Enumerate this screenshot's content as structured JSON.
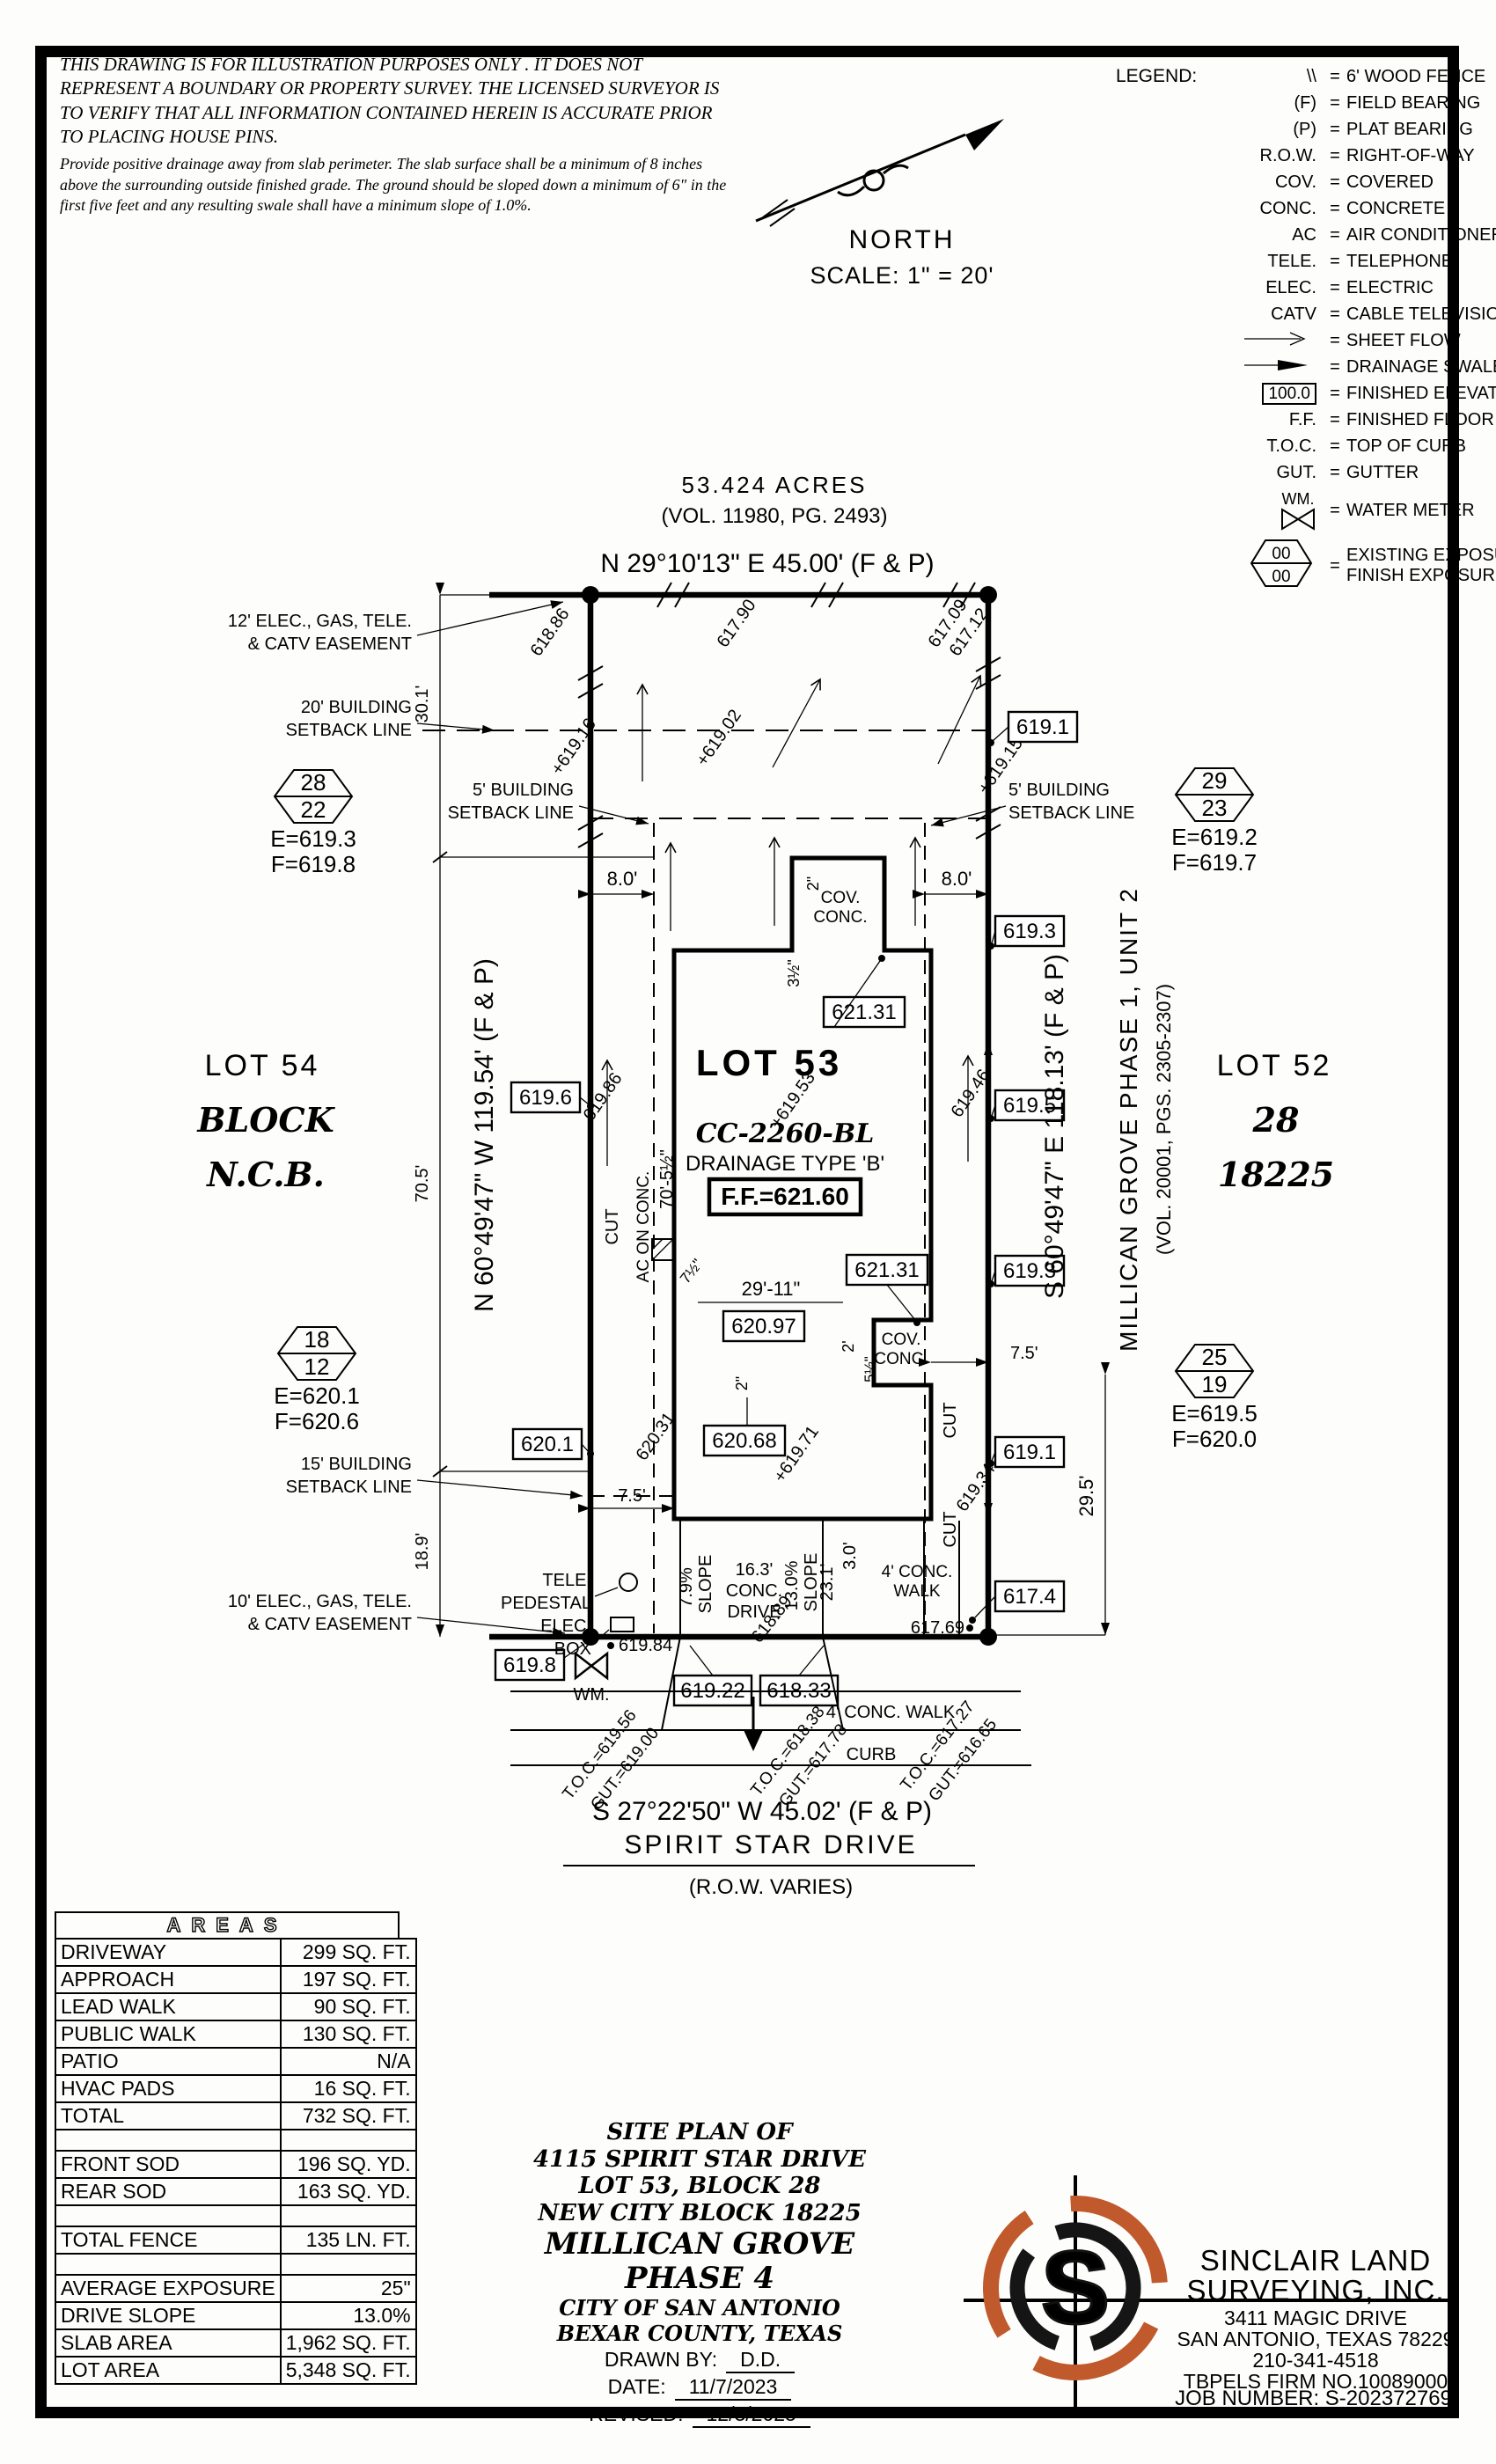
{
  "disclaimer": {
    "para1": "THIS DRAWING IS FOR ILLUSTRATION PURPOSES ONLY . IT DOES NOT REPRESENT A BOUNDARY OR PROPERTY SURVEY. THE LICENSED SURVEYOR IS TO VERIFY THAT ALL INFORMATION CONTAINED HEREIN IS ACCURATE PRIOR TO PLACING HOUSE PINS.",
    "para2": "Provide positive drainage away from slab perimeter. The slab surface shall be a minimum of 8 inches above the surrounding outside finished grade. The ground should be sloped down a minimum of 6\" in the first five feet and any resulting swale shall have a minimum slope of 1.0%."
  },
  "compass": {
    "north": "NORTH",
    "scale": "SCALE:  1\"  =  20'"
  },
  "legend": {
    "title": "LEGEND:",
    "eq": "=",
    "items": [
      {
        "sym": "\\\\",
        "desc": "6' WOOD FENCE"
      },
      {
        "sym": "(F)",
        "desc": "FIELD BEARING"
      },
      {
        "sym": "(P)",
        "desc": "PLAT BEARING"
      },
      {
        "sym": "R.O.W.",
        "desc": "RIGHT-OF-WAY"
      },
      {
        "sym": "COV.",
        "desc": "COVERED"
      },
      {
        "sym": "CONC.",
        "desc": "CONCRETE"
      },
      {
        "sym": "AC",
        "desc": "AIR CONDITIONER"
      },
      {
        "sym": "TELE.",
        "desc": "TELEPHONE"
      },
      {
        "sym": "ELEC.",
        "desc": "ELECTRIC"
      },
      {
        "sym": "CATV",
        "desc": "CABLE TELEVISION"
      },
      {
        "sym": "",
        "desc": "SHEET FLOW"
      },
      {
        "sym": "",
        "desc": "DRAINAGE SWALE"
      },
      {
        "sym": "100.0",
        "desc": "FINISHED ELEVATION"
      },
      {
        "sym": "F.F.",
        "desc": "FINISHED FLOOR"
      },
      {
        "sym": "T.O.C.",
        "desc": "TOP OF CURB"
      },
      {
        "sym": "GUT.",
        "desc": "GUTTER"
      },
      {
        "sym": "WM.",
        "desc": "WATER METER"
      },
      {
        "sym_top": "00",
        "sym_bot": "00",
        "desc": "EXISTING EXPOSURE",
        "desc2": "FINISH EXPOSURE"
      }
    ]
  },
  "survey": {
    "acres": "53.424 ACRES",
    "acres_vol": "(VOL. 11980, PG. 2493)",
    "brg_top": "N 29°10'13\" E 45.00' (F & P)",
    "brg_left": "N 60°49'47\" W 119.54' (F & P)",
    "brg_right": "S 60°49'47\" E 118.13' (F & P)",
    "brg_bottom": "S 27°22'50\" W 45.02' (F & P)",
    "street": "SPIRIT STAR DRIVE",
    "row_varies": "(R.O.W. VARIES)",
    "lot54": "LOT 54",
    "lot54_block": "BLOCK",
    "lot54_ncb": "N.C.B.",
    "lot52": "LOT 52",
    "lot52_block": "28",
    "lot52_ncb": "18225",
    "phase1": "MILLICAN GROVE PHASE 1, UNIT 2",
    "phase1_vol": "(VOL. 20001, PGS. 2305-2307)",
    "lot53": "LOT 53",
    "cc": "CC-2260-BL",
    "drainage": "DRAINAGE TYPE 'B'",
    "ff": "F.F.=621.60",
    "hex1a": "28",
    "hex1b": "22",
    "hex1e": "E=619.3",
    "hex1f": "F=619.8",
    "hex2a": "29",
    "hex2b": "23",
    "hex2e": "E=619.2",
    "hex2f": "F=619.7",
    "hex3a": "18",
    "hex3b": "12",
    "hex3e": "E=620.1",
    "hex3f": "F=620.6",
    "hex4a": "25",
    "hex4b": "19",
    "hex4e": "E=619.5",
    "hex4f": "F=620.0",
    "esmt12_1": "12' ELEC., GAS, TELE.",
    "esmt12_2": "& CATV EASEMENT",
    "sb20_1": "20' BUILDING",
    "sb20_2": "SETBACK LINE",
    "sb5_1": "5' BUILDING",
    "sb5_2": "SETBACK LINE",
    "sb15_1": "15' BUILDING",
    "sb15_2": "SETBACK LINE",
    "esmt10_1": "10' ELEC., GAS, TELE.",
    "esmt10_2": "& CATV EASEMENT",
    "tele_1": "TELE.",
    "tele_2": "PEDESTAL",
    "elec_1": "ELEC.",
    "elec_2": "BOX",
    "wm": "WM.",
    "curb": "CURB",
    "walk_bottom": "4' CONC. WALK",
    "walk_right_1": "4' CONC.",
    "walk_right_2": "WALK",
    "drive_1": "16.3'",
    "drive_2": "CONC.",
    "drive_3": "DRIVE",
    "slope1": "7.9%",
    "slope1_w": "SLOPE",
    "slope2": "13.0%",
    "slope2_w": "SLOPE",
    "cut": "CUT",
    "acon": "AC ON CONC.",
    "cov1": "COV.",
    "cov2": "CONC.",
    "d30_1": "30.1'",
    "d70_5": "70.5'",
    "d18_9": "18.9'",
    "d8_l": "8.0'",
    "d8_r": "8.0'",
    "d70_5h": "70'-5½\"",
    "d29_11": "29'-11\"",
    "d7_5l": "7.5'",
    "d7_5r": "7.5'",
    "d29_5": "29.5'",
    "d23_1": "23.1'",
    "d3_0": "3.0'",
    "d2in_a": "2\"",
    "d2in_b": "2\"",
    "d2ft": "2'",
    "d3h": "3½\"",
    "d5h": "5½\"",
    "d7h": "7½\"",
    "b619_1a": "619.1",
    "b619_3a": "619.3",
    "b619_5": "619.5",
    "b619_3b": "619.3",
    "b619_1b": "619.1",
    "b617_4": "617.4",
    "b621_31a": "621.31",
    "b621_31b": "621.31",
    "b620_97": "620.97",
    "b620_68": "620.68",
    "b620_1": "620.1",
    "b619_6": "619.6",
    "b619_8": "619.8",
    "b619_22": "619.22",
    "b618_33": "618.33",
    "p618_86": "618.86",
    "p617_90": "617.90",
    "p617_09": "617.09",
    "p617_12": "617.12",
    "p619_16": "+619.16",
    "p619_02": "+619.02",
    "p619_15": "+619.15",
    "p619_53": "+619.53",
    "p619_86": "619.86",
    "p619_46": "619.46",
    "p620_31": "620.31",
    "p619_71": "+619.71",
    "p619_34": "619.34",
    "p618_89": "618.89",
    "p619_84": "619.84",
    "p617_69": "617.69",
    "toc1": "T.O.C.=619.56",
    "gut1": "GUT.=619.00",
    "toc2": "T.O.C.=618.38",
    "gut2": "GUT.=617.78",
    "toc3": "T.O.C.=617.27",
    "gut3": "GUT.=616.65"
  },
  "areas": {
    "title": "AREAS",
    "rows": [
      {
        "l": "DRIVEWAY",
        "v": "299 SQ. FT."
      },
      {
        "l": "APPROACH",
        "v": "197 SQ. FT."
      },
      {
        "l": "LEAD WALK",
        "v": "90 SQ. FT."
      },
      {
        "l": "PUBLIC WALK",
        "v": "130 SQ. FT."
      },
      {
        "l": "PATIO",
        "v": "N/A"
      },
      {
        "l": "HVAC PADS",
        "v": "16 SQ. FT."
      },
      {
        "l": "TOTAL",
        "v": "732 SQ. FT."
      },
      {
        "l": "",
        "v": ""
      },
      {
        "l": "FRONT SOD",
        "v": "196 SQ. YD."
      },
      {
        "l": "REAR SOD",
        "v": "163 SQ. YD."
      },
      {
        "l": "",
        "v": ""
      },
      {
        "l": "TOTAL FENCE",
        "v": "135 LN. FT."
      },
      {
        "l": "",
        "v": ""
      },
      {
        "l": "AVERAGE EXPOSURE",
        "v": "25\""
      },
      {
        "l": "DRIVE SLOPE",
        "v": "13.0%"
      },
      {
        "l": "SLAB AREA",
        "v": "1,962 SQ. FT."
      },
      {
        "l": "LOT AREA",
        "v": "5,348 SQ. FT."
      }
    ]
  },
  "titleblock": {
    "l1": "SITE PLAN OF",
    "l2": "4115 SPIRIT STAR DRIVE",
    "l3": "LOT 53, BLOCK 28",
    "l4": "NEW CITY BLOCK 18225",
    "l5": "MILLICAN GROVE",
    "l6": "PHASE 4",
    "l7": "CITY OF SAN ANTONIO",
    "l8": "BEXAR COUNTY, TEXAS",
    "drawn_label": "DRAWN BY:",
    "drawn": "D.D.",
    "date_label": "DATE:",
    "date": "11/7/2023",
    "revised_label": "REVISED:",
    "revised": "12/3/2025"
  },
  "firm": {
    "name1": "SINCLAIR LAND",
    "name2": "SURVEYING, INC.",
    "addr1": "3411 MAGIC DRIVE",
    "addr2": "SAN ANTONIO, TEXAS 78229",
    "phone": "210-341-4518",
    "firm_no": "TBPELS FIRM NO.10089000",
    "job": "JOB NUMBER:  S-202372769",
    "logo_letter": "S",
    "orange": "#c05a2c"
  }
}
